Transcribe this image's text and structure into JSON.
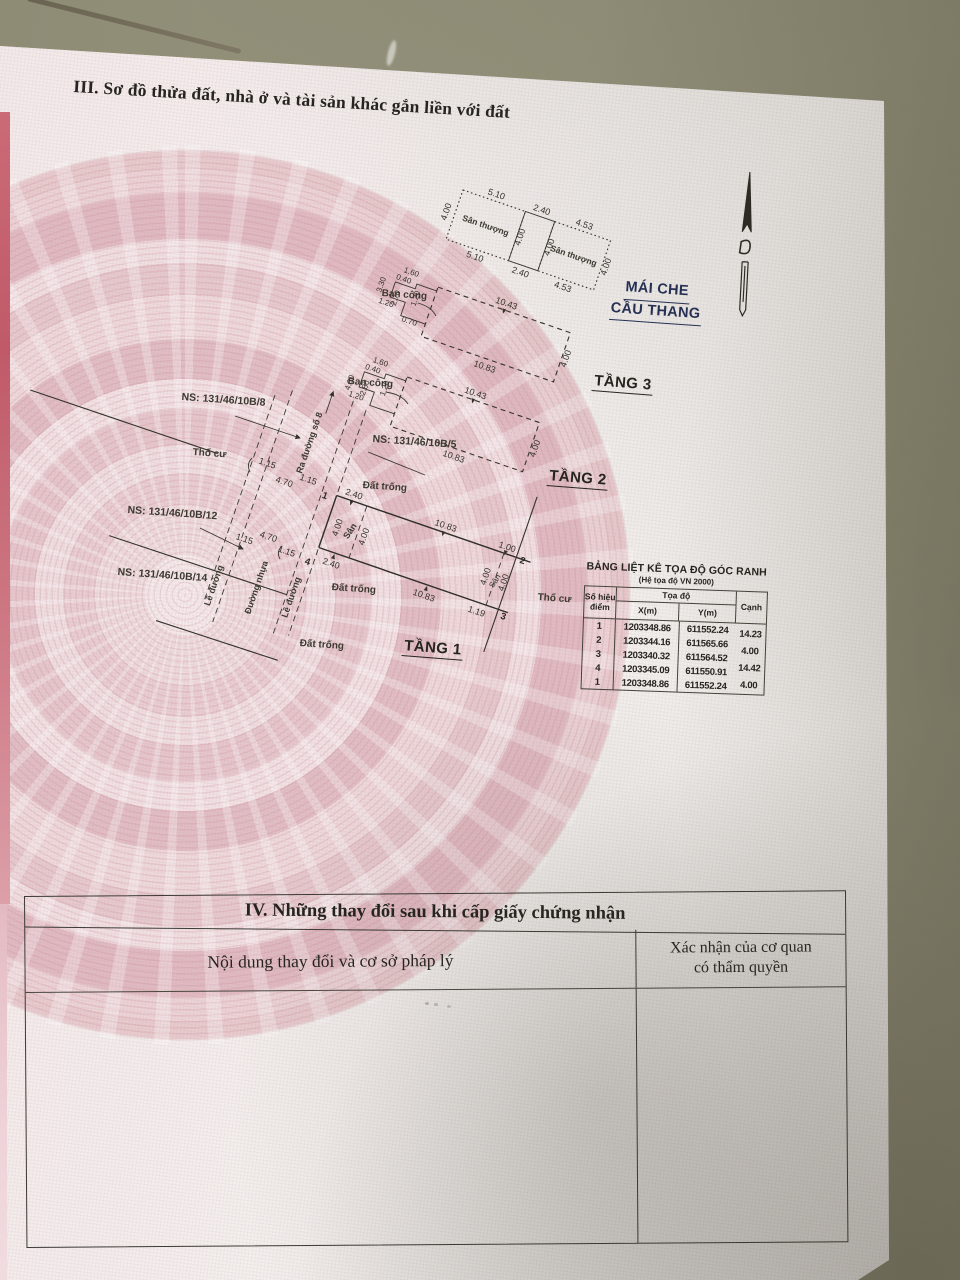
{
  "document": {
    "section3_title": "III. Sơ đồ thửa đất, nhà ở và tài sản khác gắn liền với đất",
    "section4": {
      "title": "IV. Những thay đổi sau khi cấp giấy chứng nhận",
      "col_content": "Nội dung thay đổi và cơ sở pháp lý",
      "col_confirm_1": "Xác nhận của cơ quan",
      "col_confirm_2": "có thẩm quyền"
    }
  },
  "plan": {
    "floors": {
      "f1": "TẦNG 1",
      "f2": "TẦNG 2",
      "f3": "TẦNG 3",
      "roof_line1": "MÁI CHE",
      "roof_line2": "CẦU THANG"
    },
    "parcels": {
      "ns8": "NS: 131/46/10B/8",
      "ns12": "NS: 131/46/10B/12",
      "ns14": "NS: 131/46/10B/14",
      "ns5": "NS: 131/46/10B/5"
    },
    "areas": {
      "terrace_a": "Sân thượng",
      "terrace_b": "Sân thượng",
      "balcony_f3": "Ban công",
      "balcony_f2": "Ban công",
      "yard_left": "Sân",
      "yard_right": "Sân",
      "residential_left": "Thổ cư",
      "residential_right": "Thổ cư",
      "vacant_1": "Đất trống",
      "vacant_2": "Đất trống",
      "vacant_3": "Đất trống"
    },
    "road": {
      "curb_left": "Lề đường",
      "curb_right": "Lề đường",
      "asphalt": "Đường nhựa",
      "to_street_8": "Ra đường số 8"
    },
    "dims": {
      "terrace": {
        "a_top": "5.10",
        "a_bottom": "5.10",
        "a_left": "4.00",
        "m_top": "2.40",
        "m_bottom": "2.40",
        "m_left": "4.00",
        "m_right": "4.00",
        "b_top": "4.53",
        "b_bottom": "4.53",
        "b_right": "4.00"
      },
      "f3": {
        "top": "10.43",
        "bottom": "10.83",
        "right": "4.00",
        "b1": "1.60",
        "b2": "0.40",
        "b3": "1.20",
        "b4": "3.30",
        "b5": "2.70",
        "b6": "1.20",
        "b7": "0.70"
      },
      "f2": {
        "top": "10.43",
        "bottom": "10.83",
        "right": "4.00",
        "b1": "1.60",
        "b2": "0.40",
        "b3": "1.20",
        "b4": "2.80",
        "b5": "4.00",
        "b6": "1.20"
      },
      "site": {
        "front_top": "2.40",
        "front_bottom": "2.40",
        "top_len": "10.83",
        "bottom_len": "10.83",
        "right_top": "1.00",
        "right_bottom": "1.19",
        "yard_l_a": "4.00",
        "yard_l_b": "4.00",
        "yard_r_a": "4.00",
        "yard_r_b": "4.00",
        "curb_u1": "1.15",
        "road_u": "4.70",
        "curb_u2": "1.15",
        "curb_l1": "1.15",
        "road_l": "4.70",
        "curb_l2": "1.15"
      }
    },
    "points": {
      "p1": "1",
      "p2": "2",
      "p3": "3",
      "p4": "4"
    }
  },
  "coord_table": {
    "title": "BẢNG LIỆT KÊ TỌA ĐỘ GÓC RANH",
    "subtitle": "(Hệ tọa độ VN 2000)",
    "headers": {
      "point": "Số hiệu điểm",
      "coords": "Tọa độ",
      "x": "X(m)",
      "y": "Y(m)",
      "edge": "Cạnh"
    },
    "rows": [
      {
        "p": "1",
        "x": "1203348.86",
        "y": "611552.24"
      },
      {
        "p": "2",
        "x": "1203344.16",
        "y": "611565.66"
      },
      {
        "p": "3",
        "x": "1203340.32",
        "y": "611564.52"
      },
      {
        "p": "4",
        "x": "1203345.09",
        "y": "611550.91"
      },
      {
        "p": "1",
        "x": "1203348.86",
        "y": "611552.24"
      }
    ],
    "edges": [
      "14.23",
      "4.00",
      "14.42",
      "4.00"
    ]
  }
}
